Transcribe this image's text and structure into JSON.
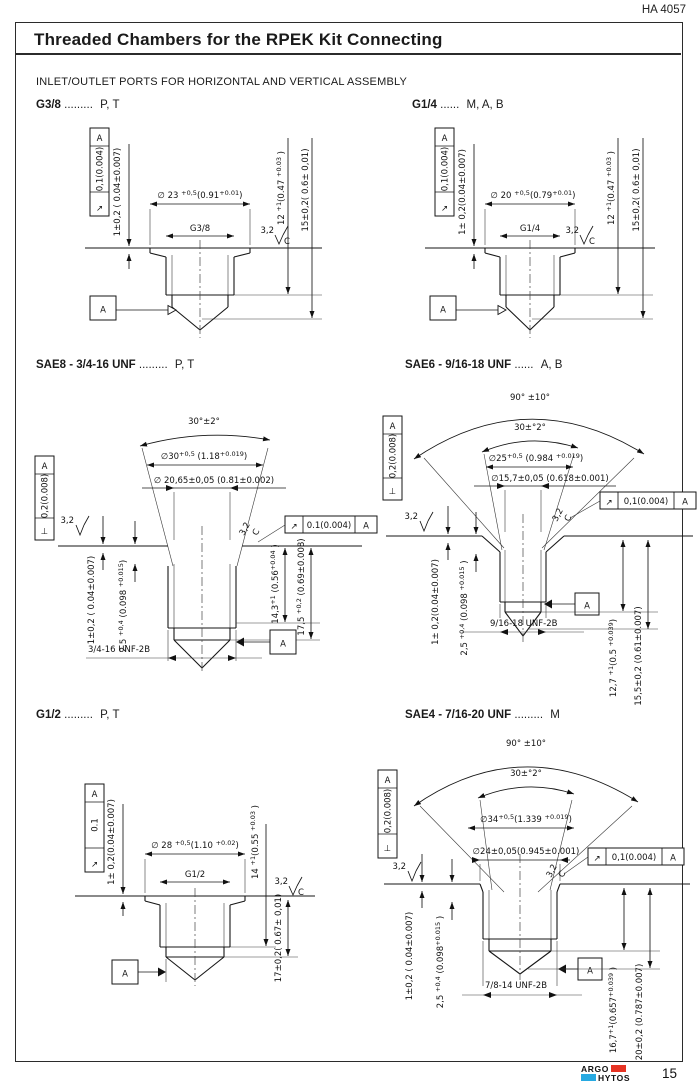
{
  "header": {
    "doc_number": "HA 4057",
    "title": "Threaded Chambers for the RPEK Kit Connecting"
  },
  "subtitle": "INLET/OUTLET PORTS FOR HORIZONTAL AND VERTICAL ASSEMBLY",
  "footer": {
    "page": "15",
    "logo_top": "ARGO",
    "logo_bottom": "HYTOS",
    "logo_red": "#e63323",
    "logo_cyan": "#27a9e1"
  },
  "drawings": {
    "g38": {
      "title": "G3/8",
      "dots": ".........",
      "ports": "P, T",
      "fcf": {
        "arrow": "↗",
        "tol": "0,1(0.004)",
        "datum": "A"
      },
      "d1": "1±0,2 ( 0.04±0.007)",
      "dia_segs": [
        {
          "t": "∅ 23 "
        },
        {
          "t": "+0,5",
          "sup": true
        },
        {
          "t": "(0.91",
          "sup": false
        },
        {
          "t": "+0.01",
          "sup": true
        },
        {
          "t": ")",
          "sup": false
        }
      ],
      "thread": "G3/8",
      "rough": "3,2",
      "rough_c": "C",
      "depth1_segs": [
        {
          "t": "12 "
        },
        {
          "t": "+1",
          "sup": true
        },
        {
          "t": "(0.47 ",
          "sup": false
        },
        {
          "t": "+0.03",
          "sup": true
        },
        {
          "t": " )",
          "sup": false
        }
      ],
      "depth2": "15±0,2( 0.6± 0,01)",
      "datum": "A"
    },
    "g14": {
      "title": "G1/4",
      "dots": "......",
      "ports": "M, A, B",
      "fcf": {
        "arrow": "↗",
        "tol": "0,1(0.004)",
        "datum": "A"
      },
      "d1": "1± 0,2(0.04±0.007)",
      "dia_segs": [
        {
          "t": "∅ 20 "
        },
        {
          "t": "+0,5",
          "sup": true
        },
        {
          "t": "(0.79",
          "sup": false
        },
        {
          "t": "+0.01",
          "sup": true
        },
        {
          "t": ")",
          "sup": false
        }
      ],
      "thread": "G1/4",
      "rough": "3,2",
      "rough_c": "C",
      "depth1_segs": [
        {
          "t": "12 "
        },
        {
          "t": "+1",
          "sup": true
        },
        {
          "t": "(0.47 ",
          "sup": false
        },
        {
          "t": "+0.03",
          "sup": true
        },
        {
          "t": " )",
          "sup": false
        }
      ],
      "depth2": "15±0,2( 0.6± 0,01)",
      "datum": "A"
    },
    "sae8": {
      "title": "SAE8 - 3/4-16 UNF",
      "dots": ".........",
      "ports": "P, T",
      "angle30": "30°±2°",
      "dia1_segs": [
        {
          "t": "∅30"
        },
        {
          "t": "+0,5",
          "sup": true
        },
        {
          "t": " (1.18",
          "sup": false
        },
        {
          "t": "+0.019",
          "sup": true
        },
        {
          "t": ")",
          "sup": false
        }
      ],
      "dia2": "∅ 20,65±0,05 (0.81±0.002)",
      "fcf_v": {
        "sym": "⊥",
        "tol": "0,2(0.008)",
        "datum": "A"
      },
      "fcf_h": {
        "arrow": "↗",
        "tol": "0.1(0.004)",
        "datum": "A"
      },
      "rough1": "3,2",
      "rough2": "3,2",
      "rough2_c": "C",
      "d1": "1±0,2 ( 0.04±0.007)",
      "d2_segs": [
        {
          "t": "2,5 "
        },
        {
          "t": "+0,4",
          "sup": true
        },
        {
          "t": " (0.098 ",
          "sup": false
        },
        {
          "t": "+0.015",
          "sup": true
        },
        {
          "t": ")",
          "sup": false
        }
      ],
      "d3_segs": [
        {
          "t": "14,3"
        },
        {
          "t": "+1",
          "sup": true
        },
        {
          "t": " (0.56",
          "sup": false
        },
        {
          "t": "+0.04",
          "sup": true
        },
        {
          "t": " )",
          "sup": false
        }
      ],
      "d4_segs": [
        {
          "t": "17,5 "
        },
        {
          "t": "+0,2",
          "sup": true
        },
        {
          "t": " (0.69±0.008)",
          "sup": false
        }
      ],
      "thread": "3/4-16 UNF-2B",
      "datum": "A"
    },
    "sae6": {
      "title": "SAE6 - 9/16-18 UNF",
      "dots": "......",
      "ports": "A, B",
      "angle90": "90° ±10°",
      "angle30": "30±°2°",
      "dia1_segs": [
        {
          "t": "∅25"
        },
        {
          "t": "+0,5",
          "sup": true
        },
        {
          "t": " (0.984 ",
          "sup": false
        },
        {
          "t": "+0.019",
          "sup": true
        },
        {
          "t": ")",
          "sup": false
        }
      ],
      "dia2": "∅15,7±0,05  (0.618±0.001)",
      "fcf_v": {
        "sym": "⊥",
        "tol": "0,2(0.008)",
        "datum": "A"
      },
      "fcf_h": {
        "arrow": "↗",
        "tol": "0,1(0.004)",
        "datum": "A"
      },
      "rough1": "3,2",
      "rough2": "3,2",
      "rough2_c": "C",
      "d1": "1± 0,2(0.04±0.007)",
      "d2_segs": [
        {
          "t": "2,5 "
        },
        {
          "t": "+0,4",
          "sup": true
        },
        {
          "t": " (0.098 ",
          "sup": false
        },
        {
          "t": "+0.015",
          "sup": true
        },
        {
          "t": " )",
          "sup": false
        }
      ],
      "d3_segs": [
        {
          "t": "12,7 "
        },
        {
          "t": "+1",
          "sup": true
        },
        {
          "t": "(0.5 ",
          "sup": false
        },
        {
          "t": "+0.039",
          "sup": true
        },
        {
          "t": ")",
          "sup": false
        }
      ],
      "d4": "15,5±0,2 (0.61±0.007)",
      "thread": "9/16-18 UNF-2B",
      "datum": "A"
    },
    "g12": {
      "title": "G1/2",
      "dots": ".........",
      "ports": "P, T",
      "fcf": {
        "arrow": "↗",
        "tol": "0.1",
        "datum": "A"
      },
      "d1": "1± 0,2(0.04±0.007)",
      "dia_segs": [
        {
          "t": "∅ 28 "
        },
        {
          "t": "+0,5",
          "sup": true
        },
        {
          "t": "(1.10 ",
          "sup": false
        },
        {
          "t": "+0.02",
          "sup": true
        },
        {
          "t": ")",
          "sup": false
        }
      ],
      "thread": "G1/2",
      "d2_segs": [
        {
          "t": "14 "
        },
        {
          "t": "+1",
          "sup": true
        },
        {
          "t": "(0.55 ",
          "sup": false
        },
        {
          "t": "+0.03",
          "sup": true
        },
        {
          "t": " )",
          "sup": false
        }
      ],
      "rough": "3,2",
      "rough_c": "C",
      "d3": "17±0,2( 0.67± 0,01)",
      "datum": "A"
    },
    "sae4": {
      "title": "SAE4 - 7/16-20 UNF",
      "dots": ".........",
      "ports": "M",
      "angle90": "90° ±10°",
      "angle30": "30±°2°",
      "dia1_segs": [
        {
          "t": "∅34"
        },
        {
          "t": "+0,5",
          "sup": true
        },
        {
          "t": "(1.339 ",
          "sup": false
        },
        {
          "t": "+0.019",
          "sup": true
        },
        {
          "t": ")",
          "sup": false
        }
      ],
      "dia2": "∅24±0,05(0.945±0.001)",
      "fcf_v": {
        "sym": "⊥",
        "tol": "0,2(0.008)",
        "datum": "A"
      },
      "fcf_h": {
        "arrow": "↗",
        "tol": "0,1(0.004)",
        "datum": "A"
      },
      "rough1": "3,2",
      "rough2": "3,2",
      "rough2_c": "C",
      "d1": "1±0,2 ( 0.04±0.007)",
      "d2_segs": [
        {
          "t": "2,5 "
        },
        {
          "t": "+0,4",
          "sup": true
        },
        {
          "t": " (0.098",
          "sup": false
        },
        {
          "t": "+0.015",
          "sup": true
        },
        {
          "t": " )",
          "sup": false
        }
      ],
      "d3_segs": [
        {
          "t": "16,7"
        },
        {
          "t": "+1",
          "sup": true
        },
        {
          "t": "(0.657",
          "sup": false
        },
        {
          "t": "+0.039",
          "sup": true
        },
        {
          "t": " )",
          "sup": false
        }
      ],
      "d4": "20±0,2 (0.787±0.007)",
      "thread": "7/8-14 UNF-2B",
      "datum": "A"
    }
  }
}
